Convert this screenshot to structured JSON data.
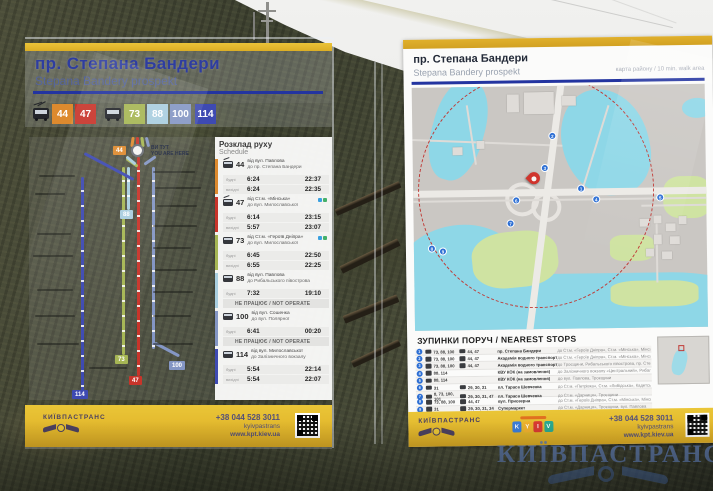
{
  "scene": {
    "watermark": "КИЇВПАСТРАНС"
  },
  "colors": {
    "sign_yellow": "#E2B42B",
    "title_blue": "#2E3DA0",
    "rule_blue": "#2334A0",
    "map_water": "#8ED7E7",
    "map_park": "#CFE3A2",
    "walk_circle_red": "#C03A36",
    "marker_blue": "#2D6FD4"
  },
  "left_sign": {
    "title": "пр. Степана Бандери",
    "subtitle": "Stepana Bandery prospekt",
    "routes": {
      "trolleybus": [
        {
          "num": "44",
          "color": "#DD8A2E"
        },
        {
          "num": "47",
          "color": "#C8342A"
        }
      ],
      "bus": [
        {
          "num": "73",
          "color": "#A6B654"
        },
        {
          "num": "88",
          "color": "#A9CEDF"
        },
        {
          "num": "100",
          "color": "#8496C4"
        },
        {
          "num": "114",
          "color": "#3E4AB2"
        }
      ]
    },
    "map": {
      "you_are_here": "ВИ ТУТ\nYOU ARE HERE"
    },
    "schedule": {
      "title": "Розклад руху",
      "subtitle": "Schedule",
      "rows": [
        {
          "num": "44",
          "from": "від вул. Павлова",
          "to": "до пр. Степана Бандери",
          "lines": [
            {
              "l": "будні",
              "a": "6:24",
              "b": "22:37"
            },
            {
              "l": "вихідні",
              "a": "6:24",
              "b": "22:35"
            }
          ]
        },
        {
          "num": "47",
          "from": "від Ст.м. «Мінська»",
          "to": "до вул. Милославської",
          "lines": [
            {
              "l": "будні",
              "a": "6:14",
              "b": "23:15"
            },
            {
              "l": "вихідні",
              "a": "5:57",
              "b": "23:07"
            }
          ]
        },
        {
          "num": "73",
          "from": "від Ст.м. «Героїв Дніпра»",
          "to": "до вул. Милославської",
          "lines": [
            {
              "l": "будні",
              "a": "6:45",
              "b": "22:50"
            },
            {
              "l": "вихідні",
              "a": "6:55",
              "b": "22:25"
            }
          ]
        },
        {
          "num": "88",
          "from": "від вул. Павлова",
          "to": "до Рибальського півострова",
          "lines": [
            {
              "l": "будні",
              "a": "7:32",
              "b": "19:10"
            }
          ],
          "note": "НЕ ПРАЦЮЄ / NOT OPERATE"
        },
        {
          "num": "100",
          "from": "від вул. Сошенка",
          "to": "до вул. Полярної",
          "lines": [
            {
              "l": "будні",
              "a": "6:41",
              "b": "00:20"
            }
          ],
          "note": "НЕ ПРАЦЮЄ / NOT OPERATE"
        },
        {
          "num": "114",
          "from": "від вул. Милославської",
          "to": "до Залізничного вокзалу",
          "lines": [
            {
              "l": "будні",
              "a": "5:54",
              "b": "22:14"
            },
            {
              "l": "вихідні",
              "a": "5:54",
              "b": "22:07"
            }
          ]
        }
      ]
    },
    "footer": {
      "brand": "КИЇВПАСТРАНС",
      "phone": "+38 044 528 3011",
      "social": "kyivpastrans",
      "site": "www.kpt.kiev.ua"
    }
  },
  "right_sign": {
    "title": "пр. Степана Бандери",
    "subtitle": "Stepana Bandery prospekt",
    "map_note": "карта району / 10 min. walk area",
    "map": {
      "markers": [
        "1",
        "2",
        "3",
        "4",
        "5",
        "6",
        "7",
        "8",
        "9"
      ]
    },
    "stops": {
      "title": "ЗУПИНКИ ПОРУЧ / NEAREST STOPS",
      "rows": [
        {
          "n": "1",
          "bus": "73, 88, 100",
          "tb": "44, 47",
          "stop": "пр. Степана Бандери",
          "dir": "до Ст.м. «Героїв Дніпра», Ст.м. «Мінська», Мінського масиву, вул. Павлова"
        },
        {
          "n": "2",
          "bus": "73, 88, 100",
          "tb": "44, 47",
          "stop": "Академія водного транспорту",
          "dir": "до Ст.м. «Героїв Дніпра», Ст.м. «Мінська», Мінського масиву, вул. Павлова"
        },
        {
          "n": "3",
          "bus": "73, 88, 100",
          "tb": "44, 47",
          "stop": "Академія водного транспорту",
          "dir": "до Троєщини, Рибальського півострова, пр. Степана Бандери"
        },
        {
          "n": "4",
          "bus": "88, 114",
          "tb": "",
          "stop": "КВУ КОК (на замовлення)",
          "dir": "до Залізничного вокзалу «Центральний», Рибальського півострова"
        },
        {
          "n": "5",
          "bus": "88, 114",
          "tb": "",
          "stop": "КВУ КОК (на замовлення)",
          "dir": "до вул. Павлова, Троєщини"
        },
        {
          "n": "6",
          "bus": "31",
          "tb": "29, 30, 31",
          "stop": "пл. Тараса Шевченка",
          "dir": "до Ст.м. «Петрівка», Ст.м. «Либідська», Кадетського Гаю"
        },
        {
          "n": "7",
          "bus": "8, 73, 100, 101",
          "tb": "29, 30, 31, 47",
          "stop": "пл. Тараса Шевченка",
          "dir": "до Ст.м. «Дарниця», Троєщини"
        },
        {
          "n": "8",
          "bus": "73, 88, 100",
          "tb": "44, 47",
          "stop": "вул. Приозерна",
          "dir": "до Ст.м. «Героїв Дніпра», Ст.м. «Мінська», Мінського масиву, вул. Павлова"
        },
        {
          "n": "9",
          "bus": "31",
          "tb": "29, 30, 31, 34",
          "stop": "Супермаркет",
          "dir": "до Ст.м. «Дарниця», Троєщини, вул. Павлова"
        }
      ]
    },
    "footer": {
      "brand": "КИЇВПАСТРАНС",
      "phone": "+38 044 528 3011",
      "social": "kyivpastrans",
      "site": "www.kpt.kiev.ua",
      "kyiv": [
        "K",
        "Y",
        "I",
        "V"
      ]
    }
  }
}
